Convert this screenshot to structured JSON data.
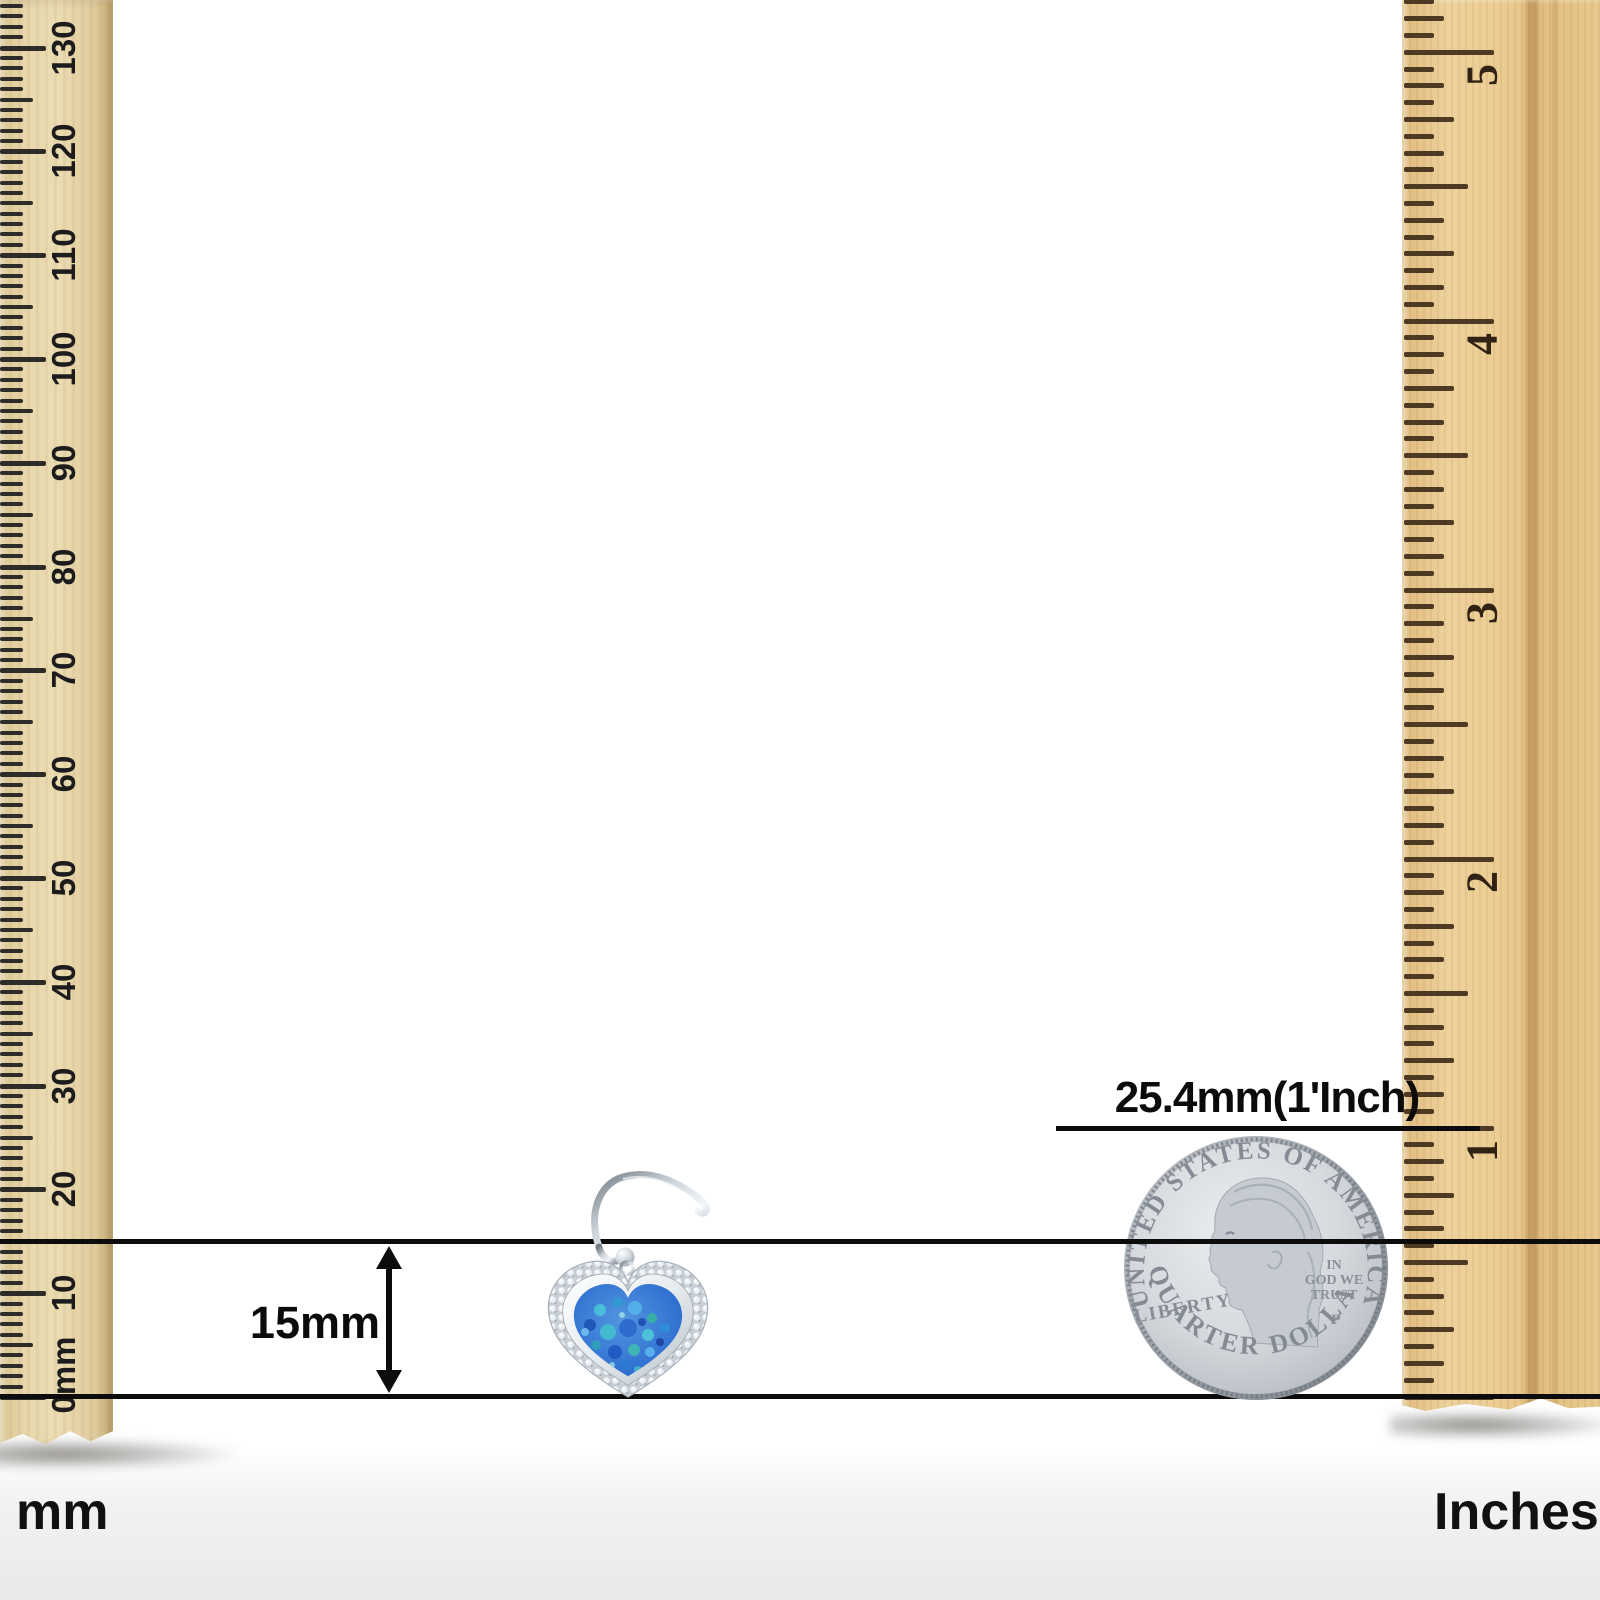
{
  "diagram": {
    "kind": "jewelry-size-reference",
    "background": "#ffffff",
    "line_color": "#0c0c0c"
  },
  "left_ruler": {
    "unit": "mm",
    "footer_label": "mm",
    "zero_label": "0mm",
    "number_labels": [
      "10",
      "20",
      "30",
      "40",
      "50",
      "60",
      "70",
      "80",
      "90",
      "100",
      "110",
      "120",
      "130"
    ],
    "wood_color": "#e8d7ab",
    "tick_color": "#1d1d1d"
  },
  "right_ruler": {
    "unit": "inches",
    "footer_label": "Inches",
    "number_labels": [
      "1",
      "2",
      "3",
      "4",
      "5"
    ],
    "wood_color": "#eccf97",
    "tick_color": "#46321d"
  },
  "annotations": {
    "pendant_height": "15mm",
    "coin_reference": "25.4mm(1'Inch)"
  },
  "coin": {
    "name": "us-quarter",
    "top_text": "UNITED STATES OF AMERICA",
    "left_text": "LIBERTY",
    "motto": [
      "IN",
      "GOD WE",
      "TRUST"
    ],
    "mint_mark": "P",
    "bottom_text": "QUARTER DOLLAR",
    "metal_color": "#c9cdd3"
  },
  "earring": {
    "style": "heart-dangle-with-cz-halo",
    "opal_color": "#3f7fd8",
    "metal_color": "#c9d0d7"
  }
}
